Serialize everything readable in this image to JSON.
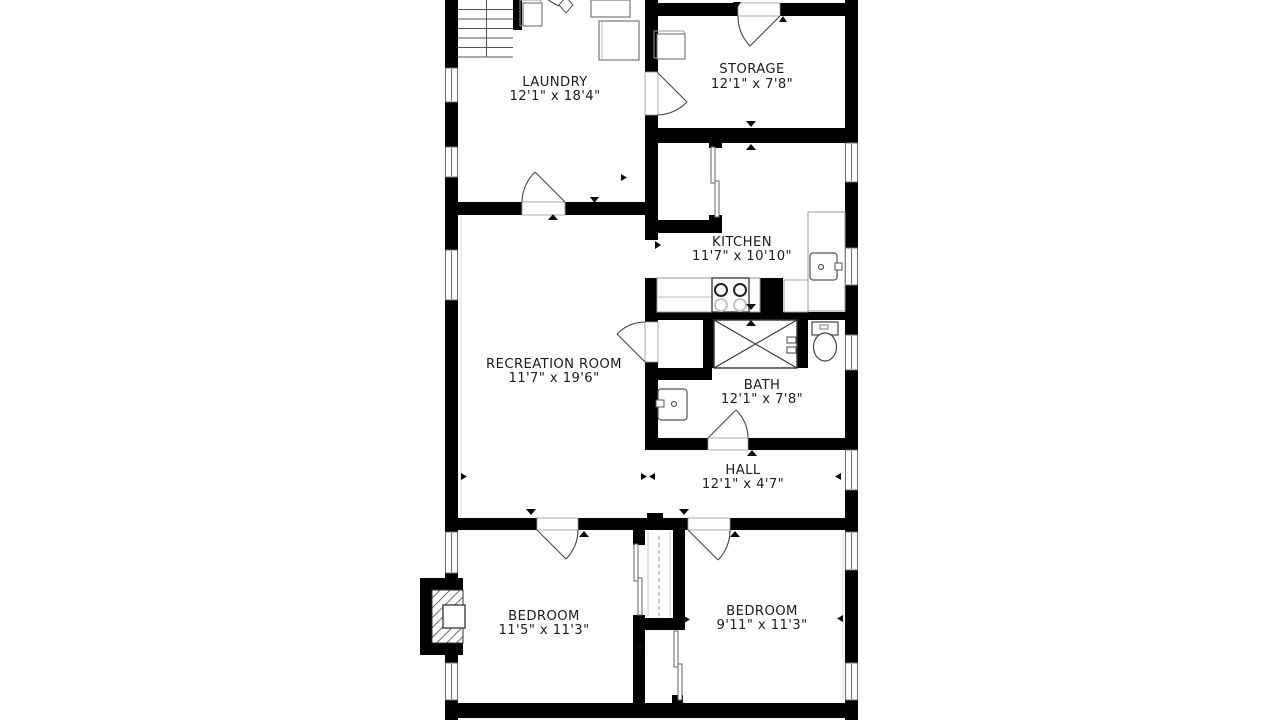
{
  "plan_title": "Basement floor plan",
  "colors": {
    "wall": "#000000",
    "text": "#1c1c1c",
    "fixture": "#555555",
    "window_frame": "#6e6e6e",
    "background": "#ffffff"
  },
  "rooms": [
    {
      "id": "laundry",
      "name": "LAUNDRY",
      "dims": "12'1\" x 18'4\""
    },
    {
      "id": "storage",
      "name": "STORAGE",
      "dims": "12'1\" x 7'8\""
    },
    {
      "id": "kitchen",
      "name": "KITCHEN",
      "dims": "11'7\" x 10'10\""
    },
    {
      "id": "recreation-room",
      "name": "RECREATION ROOM",
      "dims": "11'7\" x 19'6\""
    },
    {
      "id": "bath",
      "name": "BATH",
      "dims": "12'1\" x 7'8\""
    },
    {
      "id": "hall",
      "name": "HALL",
      "dims": "12'1\" x 4'7\""
    },
    {
      "id": "bedroom-left",
      "name": "BEDROOM",
      "dims": "11'5\" x 11'3\""
    },
    {
      "id": "bedroom-right",
      "name": "BEDROOM",
      "dims": "9'11\" x 11'3\""
    }
  ]
}
